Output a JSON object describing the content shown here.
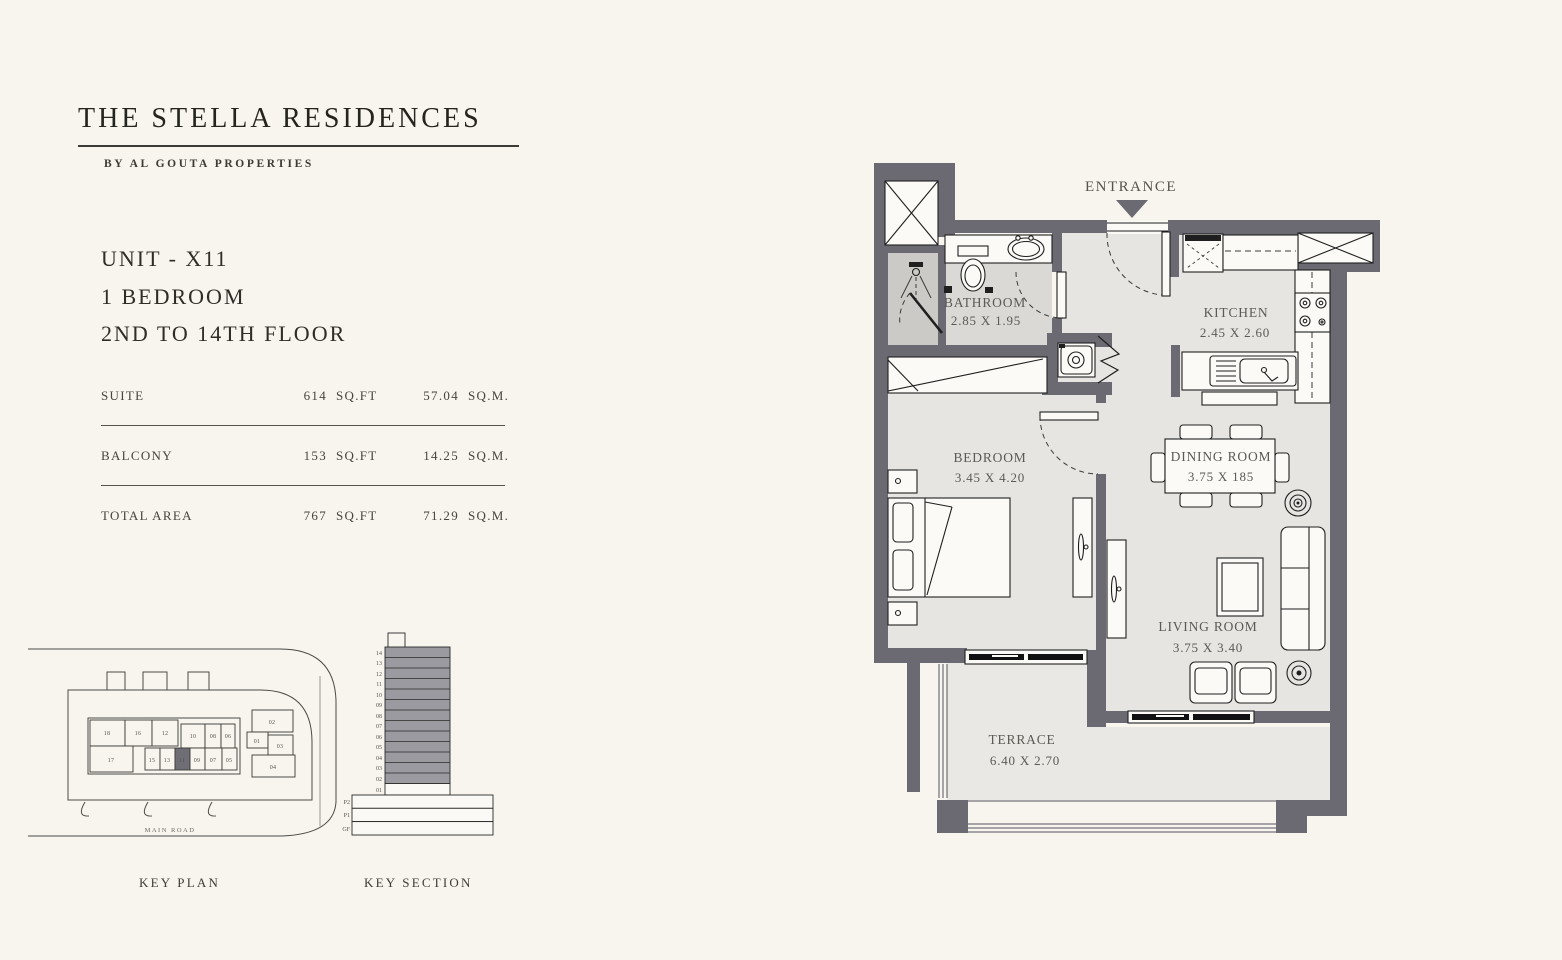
{
  "brand": {
    "title": "THE STELLA RESIDENCES",
    "subtitle": "BY AL GOUTA PROPERTIES"
  },
  "unit": {
    "lines": [
      "UNIT - X11",
      "1 BEDROOM",
      "2ND TO 14TH FLOOR"
    ]
  },
  "areas": {
    "rows": [
      {
        "label": "SUITE",
        "sqft": "614",
        "sqft_unit": "SQ.FT",
        "sqm": "57.04",
        "sqm_unit": "SQ.M."
      },
      {
        "label": "BALCONY",
        "sqft": "153",
        "sqft_unit": "SQ.FT",
        "sqm": "14.25",
        "sqm_unit": "SQ.M."
      },
      {
        "label": "TOTAL AREA",
        "sqft": "767",
        "sqft_unit": "SQ.FT",
        "sqm": "71.29",
        "sqm_unit": "SQ.M."
      }
    ]
  },
  "key_plan": {
    "caption": "KEY PLAN",
    "road_label": "MAIN ROAD",
    "highlighted_unit": "11",
    "units_top": [
      "18",
      "16",
      "12",
      "10",
      "08",
      "06"
    ],
    "units_bottom": [
      "17",
      "15",
      "13",
      "11",
      "09",
      "07",
      "05"
    ],
    "units_right": [
      "01",
      "02",
      "03",
      "04"
    ]
  },
  "key_section": {
    "caption": "KEY SECTION",
    "floors": [
      "14",
      "13",
      "12",
      "11",
      "10",
      "09",
      "08",
      "07",
      "06",
      "05",
      "04",
      "03",
      "02",
      "01"
    ],
    "podium": [
      "P2",
      "P1",
      "GF"
    ]
  },
  "floor_plan": {
    "entrance_label": "ENTRANCE",
    "rooms": [
      {
        "name": "BATHROOM",
        "dims": "2.85 X 1.95"
      },
      {
        "name": "KITCHEN",
        "dims": "2.45 X 2.60"
      },
      {
        "name": "BEDROOM",
        "dims": "3.45 X 4.20"
      },
      {
        "name": "DINING ROOM",
        "dims": "3.75 X 185"
      },
      {
        "name": "LIVING ROOM",
        "dims": "3.75 X 3.40"
      },
      {
        "name": "TERRACE",
        "dims": "6.40 X 2.70"
      }
    ]
  },
  "colors": {
    "background": "#f8f5ee",
    "wall": "#6b6a73",
    "floor": "#e7e5e1",
    "bathroom_floor": "#dbd9d5",
    "shower_floor": "#cbcac6",
    "terrace_floor": "#eae8e4",
    "tower_fill": "#9b9aa1",
    "ink": "#1f1f1f",
    "text": "#45443e",
    "title": "#26241f"
  }
}
